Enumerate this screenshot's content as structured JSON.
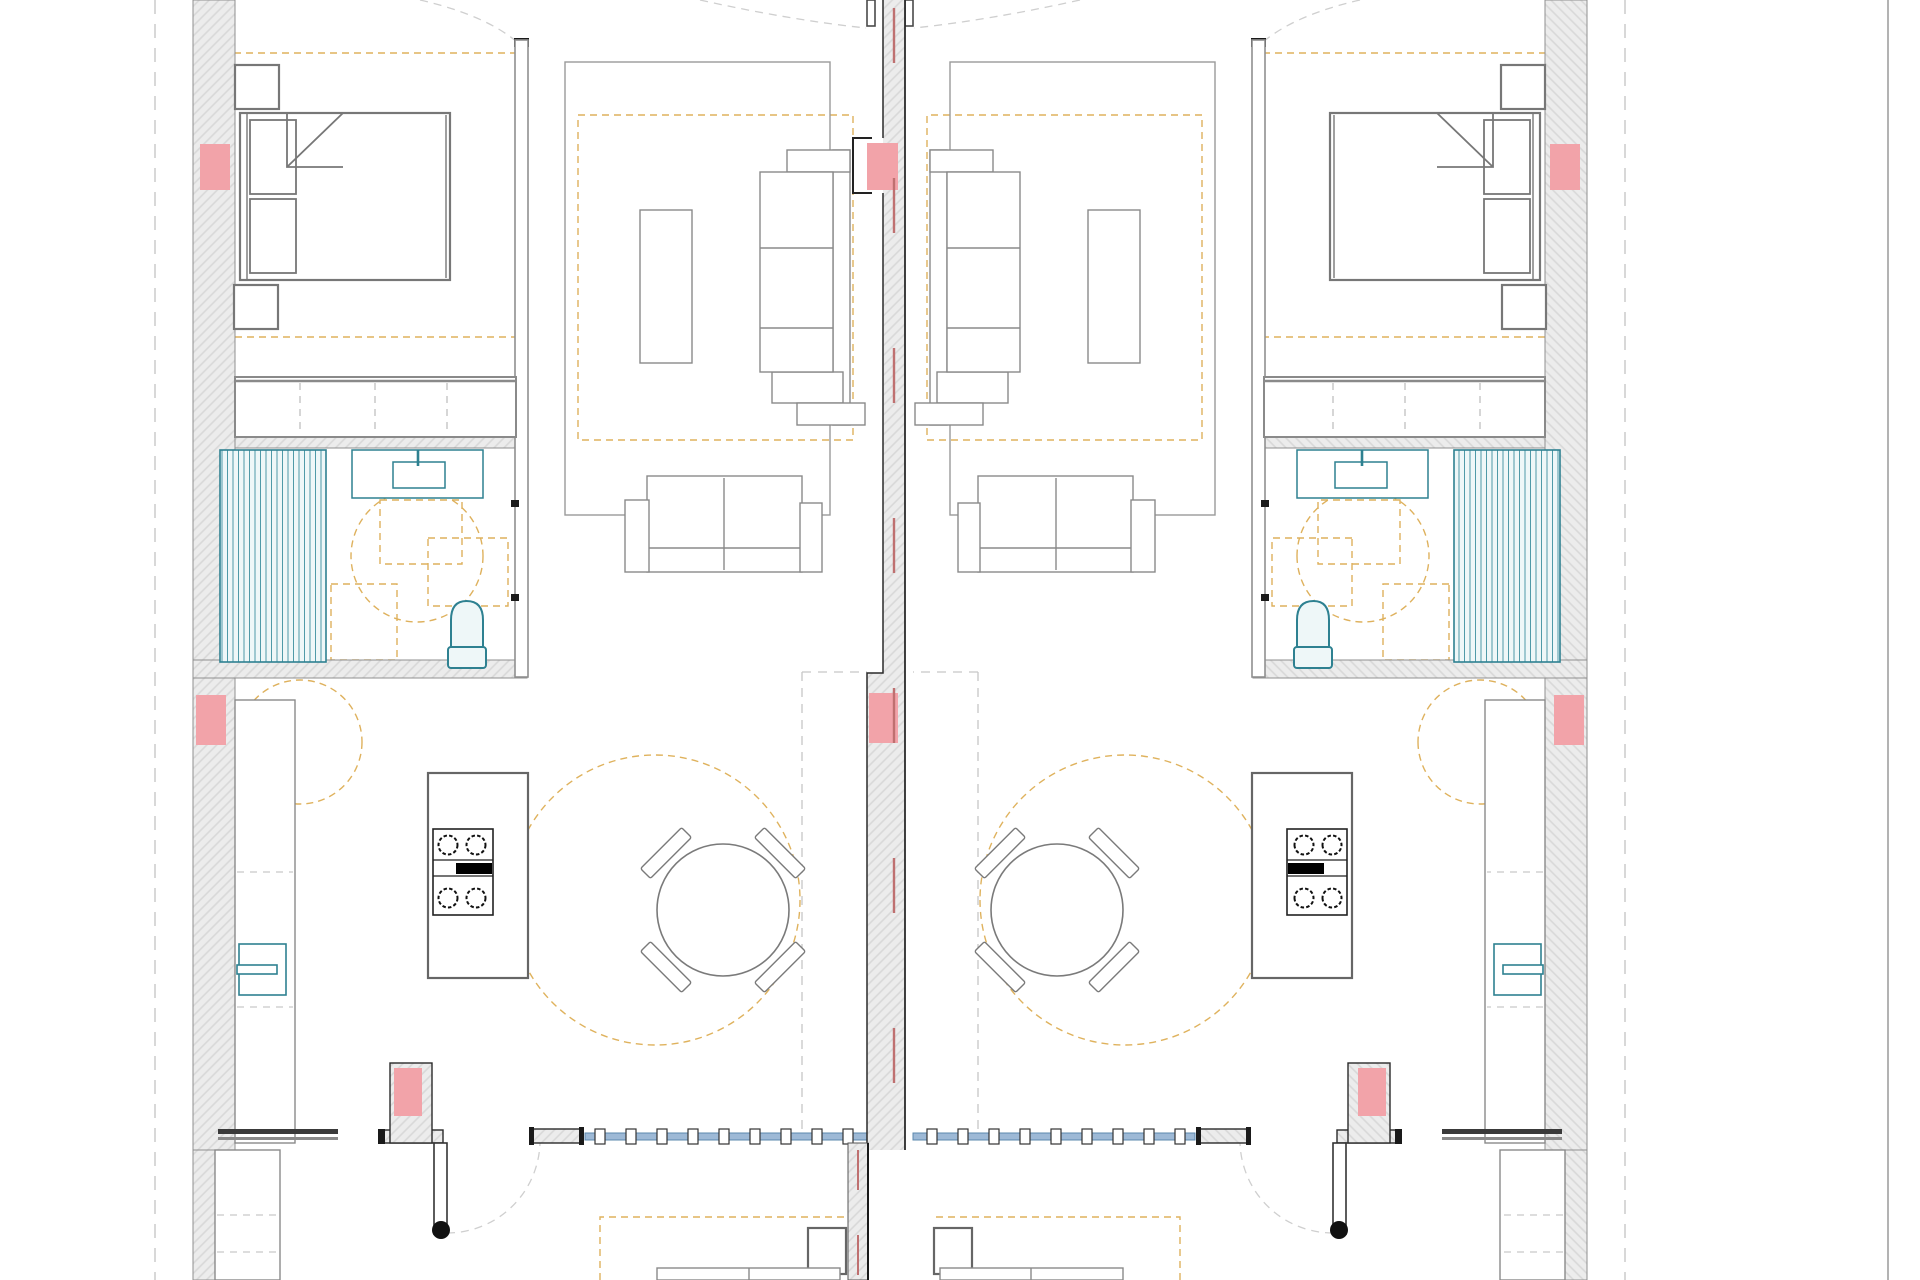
{
  "palette": {
    "paper": "#ffffff",
    "wall_fill": "#ececec",
    "wall_hatch_line": "#d8d8d8",
    "wall_edge": "#8f8f8f",
    "party_wall_edge": "#2a2a2a",
    "structure_pink": "#f2a3a9",
    "axis_pink": "#bf7070",
    "zone_dash_orange": "#d9a441",
    "plumbing_teal": "#2e8191",
    "plumbing_fill": "#eef7f8",
    "glazing_blue": "#5b88ad",
    "glazing_band": "#9db9d6",
    "furniture_gray": "#8a8a8a",
    "guide_dash_gray": "#c7c7c7",
    "black_detail": "#1a1a1a"
  },
  "drawing": {
    "kind": "architectural-floor-plan",
    "layout": "two mirrored apartment units sharing a central party wall",
    "site_lines": [
      "left-dashed-setback-line",
      "right-dashed-setback-line",
      "right-solid-boundary-line"
    ],
    "unit_rooms": [
      "bedroom",
      "closet",
      "bathroom",
      "living-room",
      "kitchen",
      "dining-area",
      "entry",
      "terrace"
    ],
    "bedroom_items": [
      "double-bed",
      "pillow",
      "pillow",
      "folded-blanket-corner",
      "nightstand-top",
      "nightstand-bottom",
      "wardrobe-strip"
    ],
    "bathroom_items": [
      "striped-shower-tray",
      "vanity-counter",
      "wash-basin",
      "toilet",
      "turning-clearance-circle",
      "clearance-squares"
    ],
    "living_items": [
      "area-rug",
      "coffee-table",
      "sectional-sofa",
      "loveseat"
    ],
    "kitchen_items": [
      "wall-counter",
      "kitchen-sink",
      "island",
      "cooktop-four-burners"
    ],
    "dining_items": [
      "round-table",
      "chair",
      "chair",
      "chair",
      "chair",
      "clearance-circle"
    ],
    "entry_items": [
      "structural-column",
      "entry-door-leaf",
      "door-swing-arc",
      "glazed-window-strip",
      "wall-stub"
    ],
    "terrace_items": [
      "dashed-outdoor-zone",
      "side-table",
      "outdoor-sofa-partial"
    ],
    "marker_meanings": {
      "pink_blocks": "structural-columns",
      "pink_dashed_centerline": "party-wall-axis",
      "orange_dashed": "zones-and-clearances",
      "teal_shapes": "plumbing-fixtures",
      "blue_strip": "glazing-mullions"
    },
    "counts": {
      "units": 2,
      "pink_blocks_total": 8,
      "dining_chairs_per_unit": 4,
      "burners_per_hob": 4
    }
  }
}
